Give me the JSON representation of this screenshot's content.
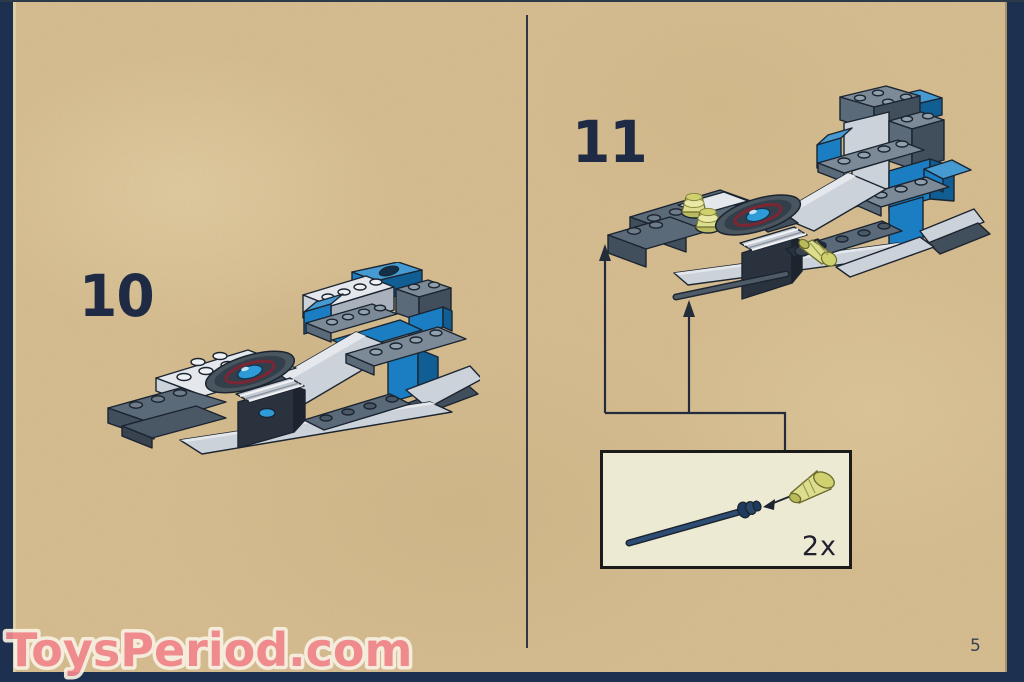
{
  "page": {
    "number": "5"
  },
  "watermark": {
    "text": "ToysPeriod.com",
    "color": "#f2878d"
  },
  "steps": [
    {
      "number": "10",
      "model": "lego-spacecraft-partial-build"
    },
    {
      "number": "11",
      "model": "lego-spacecraft-with-antennas-added"
    }
  ],
  "callout": {
    "quantity": "2x",
    "parts": [
      "black-antenna-whip-rod",
      "trans-yellow-green-cone"
    ]
  },
  "colors": {
    "page_background": "#d6bd90",
    "border_navy": "#1d3050",
    "divider": "#2e3844",
    "step_number": "#1f2a44",
    "brick_blue": "#1b7ec2",
    "brick_light_gray": "#ccd2da",
    "brick_dark_gray": "#5b6a79",
    "brick_black": "#2a323e",
    "trans_yellow": "#dcdd8d",
    "dish_ring_maroon": "#7c2634",
    "dish_center_blue": "#2f9ad8",
    "callout_background": "#edead4",
    "watermark_pink": "#f2878d"
  }
}
